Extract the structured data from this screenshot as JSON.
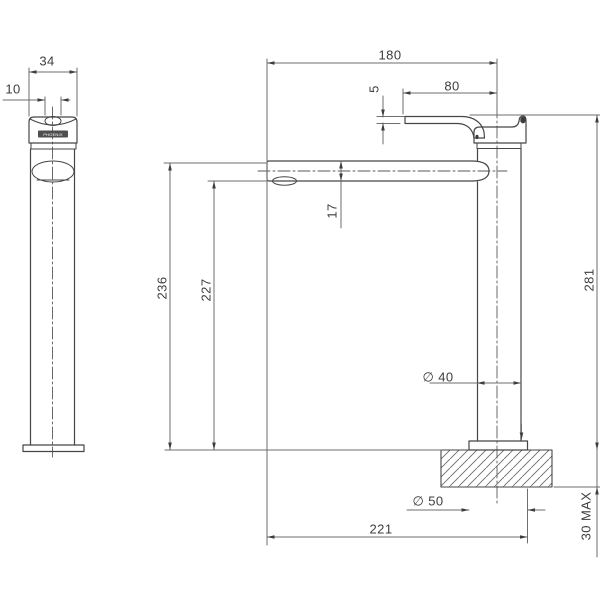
{
  "drawing": {
    "type": "technical-dimension-drawing",
    "subject": "tall basin mixer tap, side view and front view",
    "brand_badge": "PHOENIX",
    "colors": {
      "background": "#ffffff",
      "object_line": "#464646",
      "dimension_line": "#6e6e6e",
      "text": "#3d3d3d",
      "badge_fill": "#4f4f4f"
    },
    "dimensions": {
      "side_body_width": "34",
      "side_lever_width": "10",
      "spout_reach": "180",
      "handle_length": "80",
      "lever_thickness": "5",
      "spout_height": "17",
      "height_to_spout_top": "236",
      "height_to_aerator": "227",
      "overall_height": "281",
      "body_diameter": "∅ 40",
      "base_diameter": "∅ 50",
      "overall_reach": "221",
      "max_bench_thickness": "30 MAX"
    }
  }
}
